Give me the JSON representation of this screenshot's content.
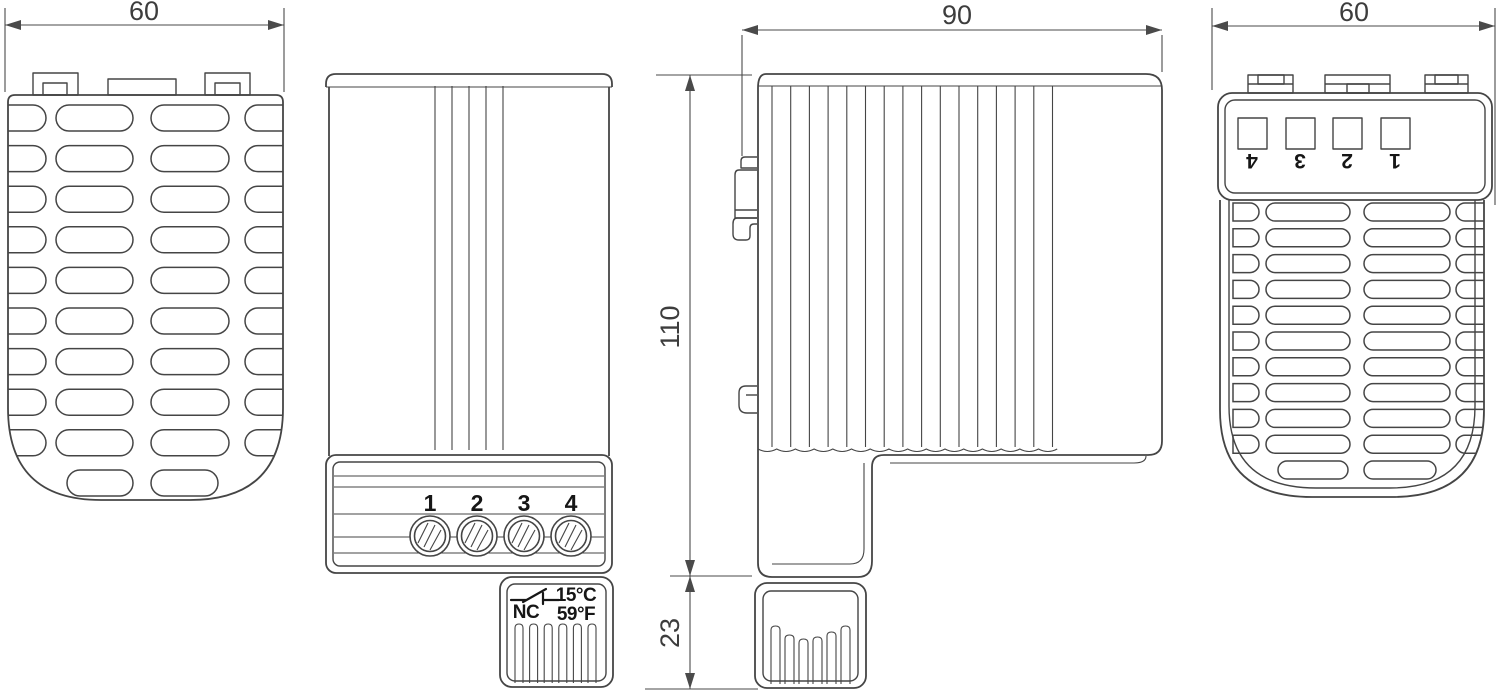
{
  "dimensions": {
    "front_width": "60",
    "depth": "90",
    "height": "110",
    "thermostat_depth": "23",
    "back_width": "60"
  },
  "front_terminals": [
    "1",
    "2",
    "3",
    "4"
  ],
  "back_terminals": [
    "4",
    "3",
    "2",
    "1"
  ],
  "thermostat_label": {
    "contact": "NC",
    "celsius": "15°C",
    "fahrenheit": "59°F"
  },
  "icons": {
    "thermostat_contact": "nc-contact-icon"
  },
  "colors": {
    "line": "#454545",
    "dimension_line": "#4a4a4a",
    "dimension_text": "#3d3d3d",
    "label_text": "#161616",
    "background": "#ffffff"
  }
}
